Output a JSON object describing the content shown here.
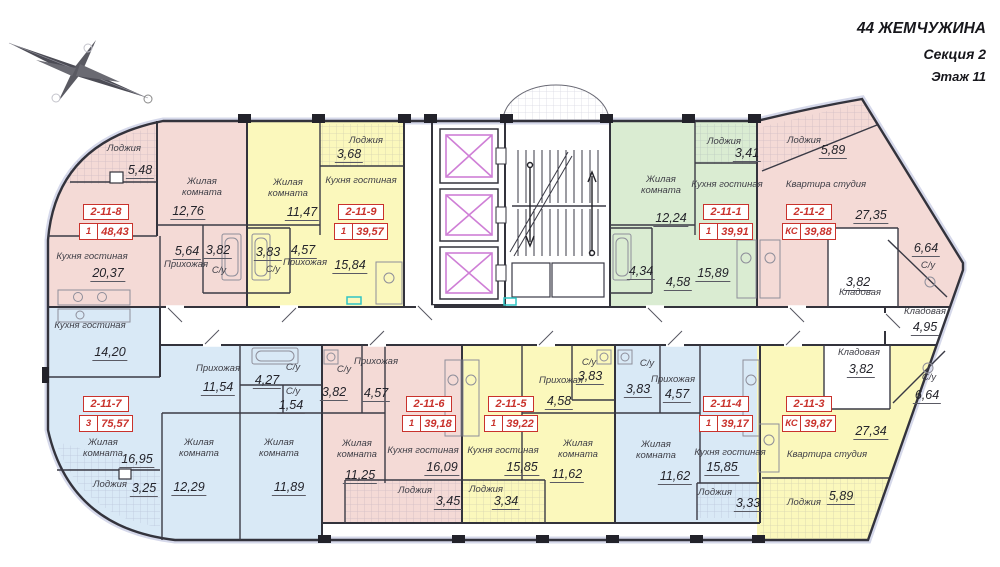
{
  "header": {
    "building": "44 ЖЕМЧУЖИНА",
    "section": "Секция 2",
    "floor": "Этаж 11"
  },
  "colors": {
    "pink": "#f4dad6",
    "yellow": "#fbf8bc",
    "green": "#daecd2",
    "blue": "#d9e9f6",
    "badge_red": "#c9322c",
    "elevator_magenta": "#cf7fd6",
    "wall": "#33333c"
  },
  "common": {
    "storage": {
      "label": "Кладовая",
      "area": "4,95"
    }
  },
  "apartments": {
    "a1": {
      "id": "2-11-1",
      "type": "1",
      "total": "39,91",
      "color": "green",
      "rooms": {
        "loggia": {
          "label": "Лоджия",
          "area": "3,41"
        },
        "living": {
          "label": "Жилая комната",
          "area": "12,24"
        },
        "kitchen": {
          "label": "Кухня гостиная",
          "area": "15,89"
        },
        "bath": {
          "area": "4,34"
        },
        "hall": {
          "area": "4,58"
        }
      }
    },
    "a2": {
      "id": "2-11-2",
      "type": "КС",
      "total": "39,88",
      "color": "pink",
      "rooms": {
        "loggia": {
          "label": "Лоджия",
          "area": "5,89"
        },
        "studio": {
          "label": "Квартира студия",
          "area": "27,35"
        },
        "bath": {
          "label": "С/у",
          "area": "6,64"
        },
        "storage": {
          "label": "Кладовая",
          "area": "3,82"
        }
      }
    },
    "a3": {
      "id": "2-11-3",
      "type": "КС",
      "total": "39,87",
      "color": "yellow",
      "rooms": {
        "storage": {
          "label": "Кладовая",
          "area": "3,82"
        },
        "bath": {
          "label": "С/у",
          "area": "6,64"
        },
        "studio": {
          "label": "Квартира студия",
          "area": "27,34"
        },
        "loggia": {
          "label": "Лоджия",
          "area": "5,89"
        }
      }
    },
    "a4": {
      "id": "2-11-4",
      "type": "1",
      "total": "39,17",
      "color": "blue",
      "rooms": {
        "bath": {
          "label": "С/у",
          "area": "3,83"
        },
        "hall": {
          "label": "Прихожая",
          "area": "4,57"
        },
        "living": {
          "label": "Жилая комната",
          "area": "11,62"
        },
        "kitchen": {
          "label": "Кухня гостиная",
          "area": "15,85"
        },
        "loggia": {
          "label": "Лоджия",
          "area": "3,33"
        }
      }
    },
    "a5": {
      "id": "2-11-5",
      "type": "1",
      "total": "39,22",
      "color": "yellow",
      "rooms": {
        "bath": {
          "label": "С/у",
          "area": "3,83"
        },
        "hall": {
          "label": "Прихожая",
          "area": "4,58"
        },
        "kitchen": {
          "label": "Кухня гостиная",
          "area": "15,85"
        },
        "living": {
          "label": "Жилая комната",
          "area": "11,62"
        },
        "loggia": {
          "label": "Лоджия",
          "area": "3,34"
        }
      }
    },
    "a6": {
      "id": "2-11-6",
      "type": "1",
      "total": "39,18",
      "color": "pink",
      "rooms": {
        "bath": {
          "label": "С/у",
          "area": "3,82"
        },
        "hall": {
          "label": "Прихожая",
          "area": "4,57"
        },
        "living": {
          "label": "Жилая комната",
          "area": "11,25"
        },
        "kitchen": {
          "label": "Кухня гостиная",
          "area": "16,09"
        },
        "loggia": {
          "label": "Лоджия",
          "area": "3,45"
        }
      }
    },
    "a7": {
      "id": "2-11-7",
      "type": "3",
      "total": "75,57",
      "color": "blue",
      "rooms": {
        "kitchen": {
          "label": "Кухня гостиная",
          "area": "14,20"
        },
        "hall": {
          "label": "Прихожая",
          "area": "11,54"
        },
        "bath": {
          "label": "С/у",
          "area": "4,27"
        },
        "bath2": {
          "label": "С/у",
          "area": "1,54"
        },
        "living": {
          "label": "Жилая комната",
          "area": "16,95"
        },
        "loggia": {
          "label": "Лоджия",
          "area": "3,25"
        },
        "living2": {
          "label": "Жилая комната",
          "area": "12,29"
        },
        "living3": {
          "label": "Жилая комната",
          "area": "11,89"
        }
      }
    },
    "a8": {
      "id": "2-11-8",
      "type": "1",
      "total": "48,43",
      "color": "pink",
      "rooms": {
        "loggia": {
          "label": "Лоджия",
          "area": "5,48"
        },
        "living": {
          "label": "Жилая комната",
          "area": "12,76"
        },
        "kitchen": {
          "label": "Кухня гостиная",
          "area": "20,37"
        },
        "hall": {
          "label": "Прихожая",
          "area": "5,64"
        },
        "bath": {
          "label": "С/у",
          "area": "3,82"
        }
      }
    },
    "a9": {
      "id": "2-11-9",
      "type": "1",
      "total": "39,57",
      "color": "yellow",
      "rooms": {
        "loggia": {
          "label": "Лоджия",
          "area": "3,68"
        },
        "living": {
          "label": "Жилая комната",
          "area": "11,47"
        },
        "bath": {
          "label": "С/у",
          "area": "3,83"
        },
        "hall": {
          "label": "Прихожая",
          "area": "4,57"
        },
        "kitchen": {
          "label": "Кухня гостиная",
          "area": "15,84"
        }
      }
    }
  }
}
